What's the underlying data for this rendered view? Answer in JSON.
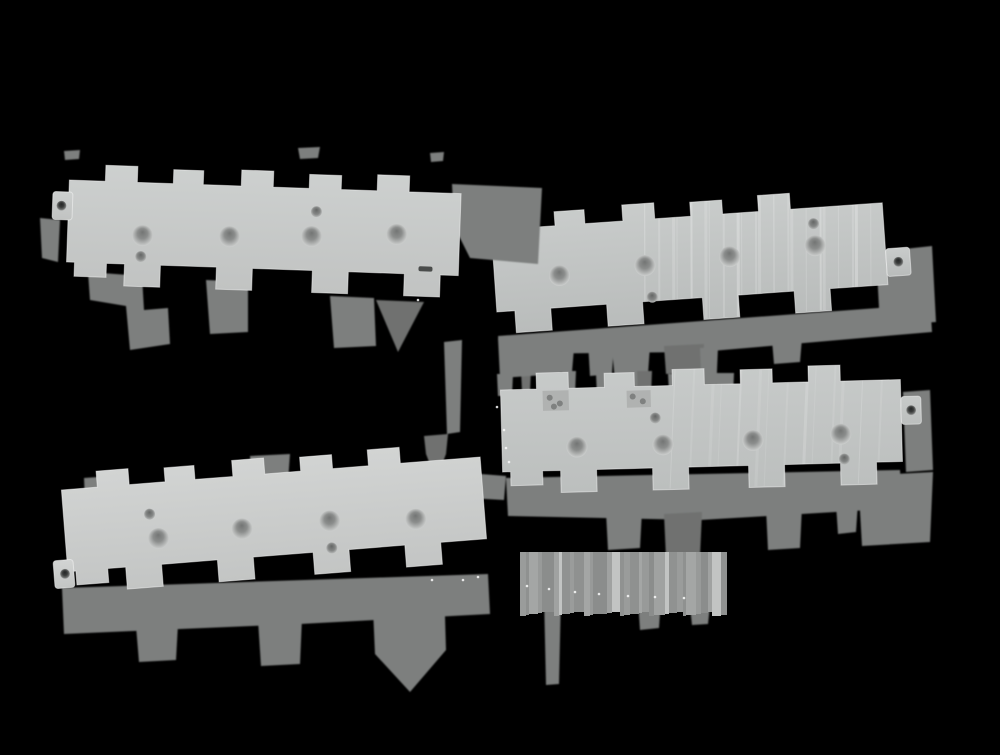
{
  "scene": {
    "description": "Product photograph of four light-gray machined mounting plates with castellated zig-zag edges and circular screw holes, arranged in two overlapping diagonal rows on a black background with hard-edged gray drop shadows",
    "width": 1000,
    "height": 755,
    "background_color": "#000000"
  },
  "colors": {
    "shadow_mid": "#7d7f7e",
    "shadow_dark": "#6f7170",
    "shadow_light": "#8a8c8b",
    "edge_highlight": "rgba(255,255,255,0.45)",
    "speck": "#fafafa",
    "notch_fill": "#b0b2b1",
    "notch_dot": "#7f8180",
    "slot_fill": "#4a4c4b",
    "hole_grad": [
      "#737574",
      "#8b8d8c",
      "#b4b6b5",
      "#d6d8d7"
    ],
    "small_hole_grad": [
      "#646665",
      "#858786",
      "#c2c4c3"
    ],
    "tab_hole_grad": [
      "#242626",
      "#3a3c3b",
      "#6a6c6b",
      "#cfd1d0"
    ],
    "stripe_tones": [
      "#9a9c9b",
      "#8f9190",
      "#a4a6a5",
      "#989a99",
      "#8b8d8c",
      "#a0a2a1",
      "#c2c4c3",
      "#909291"
    ]
  },
  "plates": [
    {
      "name": "plate-upper-right",
      "z": 1,
      "transform": {
        "x": 450,
        "y": 215,
        "rotate": -4
      },
      "x0": 40,
      "length": 432,
      "tone_top": "#c9cccb",
      "tone_bottom": "#b9bcbb",
      "big_holes": [
        [
          105,
          68
        ],
        [
          191,
          64
        ],
        [
          276,
          61
        ],
        [
          362,
          56
        ]
      ],
      "small_holes": [
        [
          362,
          34
        ],
        [
          196,
          96
        ]
      ],
      "left_tab": null,
      "right_tab": {
        "x": 432,
        "y": 64,
        "w": 24,
        "h": 28,
        "hole": [
          444,
          78
        ]
      },
      "notches": [
        {
          "x": 52,
          "y": 20,
          "w": 22,
          "h": 18,
          "holes": [
            [
              6,
              6
            ],
            [
              15,
              12
            ]
          ]
        }
      ],
      "slots": [],
      "streaks": {
        "from": 200,
        "to": 430,
        "count": 22,
        "opacity": 0.16
      }
    },
    {
      "name": "plate-upper-left",
      "z": 2,
      "transform": {
        "x": 70,
        "y": 162,
        "rotate": 2
      },
      "x0": 0,
      "length": 392,
      "tone_top": "#cdd0cf",
      "tone_bottom": "#c1c3c2",
      "big_holes": [
        [
          75,
          71
        ],
        [
          162,
          69
        ],
        [
          244,
          66
        ],
        [
          329,
          61
        ]
      ],
      "small_holes": [
        [
          74,
          92
        ],
        [
          248,
          41
        ]
      ],
      "left_tab": {
        "x": -16,
        "y": 30,
        "w": 20,
        "h": 28,
        "hole": [
          -7,
          44
        ]
      },
      "right_tab": null,
      "notches": [],
      "slots": [
        {
          "x": 352,
          "y": 92,
          "w": 14,
          "h": 5
        }
      ],
      "streaks": null
    },
    {
      "name": "plate-lower-left",
      "z": 3,
      "transform": {
        "x": 60,
        "y": 472,
        "rotate": -4.5
      },
      "x0": 0,
      "length": 420,
      "tone_top": "#d2d4d3",
      "tone_bottom": "#c3c5c4",
      "big_holes": [
        [
          93,
          74
        ],
        [
          177,
          71
        ],
        [
          265,
          70
        ],
        [
          351,
          75
        ]
      ],
      "small_holes": [
        [
          86,
          49
        ],
        [
          265,
          97
        ]
      ],
      "left_tab": {
        "x": -14,
        "y": 88,
        "w": 20,
        "h": 28,
        "hole": [
          -3,
          102
        ]
      },
      "right_tab": null,
      "notches": [],
      "slots": [],
      "streaks": null
    },
    {
      "name": "plate-lower-right",
      "z": 4,
      "transform": {
        "x": 500,
        "y": 372,
        "rotate": -1.5
      },
      "x0": 0,
      "length": 400,
      "tone_top": "#c7cac9",
      "tone_bottom": "#bcbfbe",
      "big_holes": [
        [
          75,
          77
        ],
        [
          161,
          77
        ],
        [
          251,
          75
        ],
        [
          339,
          71
        ]
      ],
      "small_holes": [
        [
          154,
          50
        ],
        [
          342,
          96
        ]
      ],
      "left_tab": null,
      "right_tab": {
        "x": 400,
        "y": 35,
        "w": 20,
        "h": 28,
        "hole": [
          410,
          49
        ]
      },
      "notches": [
        {
          "x": 42,
          "y": 20,
          "w": 26,
          "h": 20,
          "holes": [
            [
              7,
              7
            ],
            [
              17,
              13
            ],
            [
              11,
              16
            ]
          ]
        },
        {
          "x": 126,
          "y": 22,
          "w": 24,
          "h": 17,
          "holes": [
            [
              6,
              6
            ],
            [
              16,
              11
            ]
          ]
        }
      ],
      "slots": [],
      "streaks": {
        "from": 180,
        "to": 395,
        "count": 14,
        "opacity": 0.1
      }
    }
  ],
  "shadows": [
    {
      "layer": "bg",
      "tone": "mid",
      "points": [
        [
          88,
          272
        ],
        [
          142,
          276
        ],
        [
          144,
          310
        ],
        [
          168,
          308
        ],
        [
          170,
          344
        ],
        [
          130,
          350
        ],
        [
          126,
          306
        ],
        [
          90,
          300
        ]
      ]
    },
    {
      "layer": "bg",
      "tone": "mid",
      "points": [
        [
          206,
          280
        ],
        [
          248,
          282
        ],
        [
          248,
          332
        ],
        [
          210,
          334
        ]
      ]
    },
    {
      "layer": "bg",
      "tone": "mid",
      "points": [
        [
          330,
          296
        ],
        [
          374,
          298
        ],
        [
          376,
          346
        ],
        [
          334,
          348
        ]
      ]
    },
    {
      "layer": "bg",
      "tone": "dark",
      "points": [
        [
          376,
          300
        ],
        [
          424,
          302
        ],
        [
          398,
          352
        ]
      ]
    },
    {
      "layer": "bg",
      "tone": "mid",
      "points": [
        [
          498,
          336
        ],
        [
          878,
          308
        ],
        [
          930,
          300
        ],
        [
          932,
          332
        ],
        [
          700,
          352
        ],
        [
          500,
          354
        ]
      ]
    },
    {
      "layer": "bg",
      "tone": "mid",
      "points": [
        [
          540,
          350
        ],
        [
          574,
          348
        ],
        [
          572,
          372
        ],
        [
          542,
          374
        ]
      ]
    },
    {
      "layer": "bg",
      "tone": "dark",
      "points": [
        [
          664,
          346
        ],
        [
          704,
          344
        ],
        [
          702,
          372
        ],
        [
          666,
          374
        ]
      ]
    },
    {
      "layer": "bg",
      "tone": "mid",
      "points": [
        [
          772,
          340
        ],
        [
          802,
          338
        ],
        [
          800,
          362
        ],
        [
          774,
          364
        ]
      ]
    },
    {
      "layer": "bg",
      "tone": "mid",
      "points": [
        [
          876,
          252
        ],
        [
          932,
          246
        ],
        [
          936,
          322
        ],
        [
          880,
          326
        ]
      ]
    },
    {
      "layer": "bg",
      "tone": "mid",
      "points": [
        [
          40,
          218
        ],
        [
          60,
          220
        ],
        [
          58,
          262
        ],
        [
          42,
          258
        ]
      ]
    },
    {
      "layer": "bg",
      "tone": "mid",
      "points": [
        [
          298,
          148
        ],
        [
          320,
          147
        ],
        [
          318,
          158
        ],
        [
          300,
          159
        ]
      ]
    },
    {
      "layer": "bg",
      "tone": "mid",
      "points": [
        [
          64,
          151
        ],
        [
          80,
          150
        ],
        [
          79,
          159
        ],
        [
          65,
          160
        ]
      ]
    },
    {
      "layer": "bg",
      "tone": "mid",
      "points": [
        [
          430,
          153
        ],
        [
          444,
          152
        ],
        [
          443,
          161
        ],
        [
          431,
          162
        ]
      ]
    },
    {
      "layer": "bg",
      "tone": "mid",
      "points": [
        [
          444,
          342
        ],
        [
          462,
          340
        ],
        [
          460,
          432
        ],
        [
          447,
          434
        ]
      ]
    },
    {
      "layer": "bg",
      "tone": "mid",
      "points": [
        [
          612,
          348
        ],
        [
          650,
          346
        ],
        [
          646,
          402
        ],
        [
          631,
          440
        ],
        [
          617,
          404
        ]
      ]
    },
    {
      "layer": "bg",
      "tone": "mid",
      "points": [
        [
          700,
          348
        ],
        [
          718,
          347
        ],
        [
          716,
          394
        ],
        [
          702,
          395
        ]
      ]
    },
    {
      "layer": "bg",
      "tone": "mid",
      "points": [
        [
          497,
          374
        ],
        [
          513,
          374
        ],
        [
          512,
          396
        ],
        [
          498,
          396
        ]
      ]
    },
    {
      "layer": "bg",
      "tone": "dark",
      "points": [
        [
          521,
          370
        ],
        [
          531,
          370
        ],
        [
          530,
          392
        ],
        [
          522,
          392
        ]
      ]
    },
    {
      "layer": "bg",
      "tone": "mid",
      "points": [
        [
          543,
          376
        ],
        [
          552,
          376
        ],
        [
          551,
          394
        ],
        [
          544,
          394
        ]
      ]
    },
    {
      "layer": "bg",
      "tone": "mid",
      "points": [
        [
          562,
          371
        ],
        [
          576,
          371
        ],
        [
          575,
          395
        ],
        [
          563,
          395
        ]
      ]
    },
    {
      "layer": "bg",
      "tone": "mid",
      "points": [
        [
          596,
          374
        ],
        [
          620,
          374
        ],
        [
          619,
          396
        ],
        [
          597,
          396
        ]
      ]
    },
    {
      "layer": "bg",
      "tone": "dark",
      "points": [
        [
          637,
          371
        ],
        [
          652,
          371
        ],
        [
          651,
          395
        ],
        [
          638,
          395
        ]
      ]
    },
    {
      "layer": "bg",
      "tone": "mid",
      "points": [
        [
          668,
          374
        ],
        [
          678,
          374
        ],
        [
          677,
          392
        ],
        [
          669,
          392
        ]
      ]
    },
    {
      "layer": "bg",
      "tone": "mid",
      "points": [
        [
          716,
          373
        ],
        [
          734,
          373
        ],
        [
          733,
          397
        ],
        [
          717,
          397
        ]
      ]
    },
    {
      "layer": "bg",
      "tone": "mid",
      "points": [
        [
          903,
          392
        ],
        [
          930,
          390
        ],
        [
          933,
          470
        ],
        [
          906,
          472
        ]
      ]
    },
    {
      "layer": "bg",
      "tone": "mid",
      "points": [
        [
          858,
          476
        ],
        [
          933,
          472
        ],
        [
          930,
          542
        ],
        [
          862,
          546
        ]
      ]
    },
    {
      "layer": "bg",
      "tone": "mid",
      "points": [
        [
          506,
          478
        ],
        [
          900,
          470
        ],
        [
          902,
          508
        ],
        [
          700,
          520
        ],
        [
          508,
          516
        ]
      ]
    },
    {
      "layer": "bg",
      "tone": "mid",
      "points": [
        [
          606,
          512
        ],
        [
          642,
          510
        ],
        [
          640,
          548
        ],
        [
          608,
          550
        ]
      ]
    },
    {
      "layer": "bg",
      "tone": "dark",
      "points": [
        [
          664,
          514
        ],
        [
          702,
          512
        ],
        [
          700,
          556
        ],
        [
          666,
          558
        ]
      ]
    },
    {
      "layer": "bg",
      "tone": "mid",
      "points": [
        [
          766,
          508
        ],
        [
          802,
          506
        ],
        [
          800,
          548
        ],
        [
          768,
          550
        ]
      ]
    },
    {
      "layer": "bg",
      "tone": "mid",
      "points": [
        [
          836,
          504
        ],
        [
          858,
          502
        ],
        [
          856,
          532
        ],
        [
          838,
          534
        ]
      ]
    },
    {
      "layer": "bg",
      "tone": "mid",
      "points": [
        [
          430,
          470
        ],
        [
          506,
          476
        ],
        [
          504,
          500
        ],
        [
          432,
          496
        ]
      ]
    },
    {
      "layer": "bg",
      "tone": "mid",
      "points": [
        [
          62,
          588
        ],
        [
          488,
          574
        ],
        [
          490,
          614
        ],
        [
          300,
          624
        ],
        [
          64,
          634
        ]
      ]
    },
    {
      "layer": "bg",
      "tone": "mid",
      "points": [
        [
          136,
          626
        ],
        [
          178,
          624
        ],
        [
          176,
          660
        ],
        [
          139,
          662
        ]
      ]
    },
    {
      "layer": "bg",
      "tone": "mid",
      "points": [
        [
          258,
          620
        ],
        [
          302,
          618
        ],
        [
          300,
          664
        ],
        [
          261,
          666
        ]
      ]
    },
    {
      "layer": "bg",
      "tone": "mid",
      "points": [
        [
          372,
          586
        ],
        [
          444,
          582
        ],
        [
          446,
          650
        ],
        [
          410,
          692
        ],
        [
          375,
          654
        ]
      ]
    },
    {
      "layer": "bg",
      "tone": "mid",
      "points": [
        [
          544,
          596
        ],
        [
          561,
          595
        ],
        [
          559,
          684
        ],
        [
          546,
          685
        ]
      ]
    },
    {
      "layer": "bg",
      "tone": "mid",
      "points": [
        [
          638,
          600
        ],
        [
          661,
          598
        ],
        [
          659,
          628
        ],
        [
          640,
          630
        ]
      ]
    },
    {
      "layer": "bg",
      "tone": "mid",
      "points": [
        [
          690,
          606
        ],
        [
          710,
          605
        ],
        [
          708,
          624
        ],
        [
          692,
          625
        ]
      ]
    },
    {
      "layer": "bg",
      "tone": "mid",
      "points": [
        [
          84,
          478
        ],
        [
          112,
          476
        ],
        [
          114,
          524
        ],
        [
          86,
          526
        ]
      ]
    },
    {
      "layer": "bg",
      "tone": "mid",
      "points": [
        [
          250,
          456
        ],
        [
          290,
          454
        ],
        [
          288,
          482
        ],
        [
          252,
          484
        ]
      ]
    },
    {
      "layer": "bg",
      "tone": "dark",
      "points": [
        [
          424,
          436
        ],
        [
          448,
          434
        ],
        [
          446,
          454
        ],
        [
          436,
          480
        ],
        [
          426,
          454
        ]
      ]
    },
    {
      "layer": "bg",
      "tone": "mid",
      "points": [
        [
          498,
          338
        ],
        [
          562,
          334
        ],
        [
          560,
          374
        ],
        [
          500,
          378
        ]
      ]
    },
    {
      "layer": "bg",
      "tone": "mid",
      "points": [
        [
          588,
          342
        ],
        [
          614,
          340
        ],
        [
          612,
          374
        ],
        [
          590,
          376
        ]
      ]
    },
    {
      "layer": "overlay",
      "tone": "mid",
      "points": [
        [
          452,
          184
        ],
        [
          542,
          188
        ],
        [
          538,
          264
        ],
        [
          470,
          258
        ],
        [
          454,
          226
        ]
      ]
    }
  ],
  "stripe_band": {
    "x": 520,
    "y": 552,
    "width": 222,
    "height": 64,
    "stripe_widths": [
      6,
      3,
      9,
      4,
      12,
      5,
      3,
      8,
      4,
      10,
      6,
      3,
      14,
      5,
      8,
      4,
      6,
      9,
      3,
      7,
      5,
      11,
      4,
      8,
      6,
      3,
      10,
      5,
      7,
      4,
      9,
      6
    ],
    "comment_tone_index": "cycles through colors.stripe_tones"
  },
  "edge_specks": [
    [
      527,
      586
    ],
    [
      549,
      589
    ],
    [
      575,
      592
    ],
    [
      599,
      594
    ],
    [
      628,
      596
    ],
    [
      655,
      597
    ],
    [
      684,
      598
    ],
    [
      504,
      430
    ],
    [
      506,
      448
    ],
    [
      509,
      462
    ],
    [
      463,
      580
    ],
    [
      478,
      577
    ],
    [
      432,
      580
    ],
    [
      418,
      300
    ],
    [
      497,
      407
    ]
  ]
}
